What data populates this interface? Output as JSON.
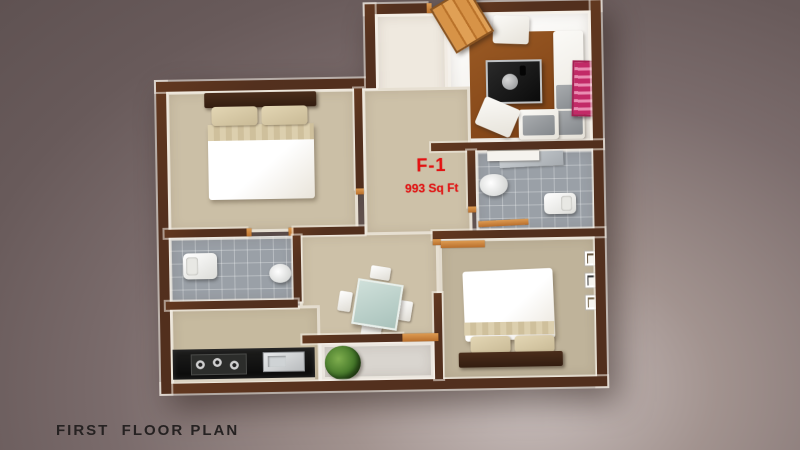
{
  "page": {
    "caption": "FIRST  FLOOR PLAN"
  },
  "unit": {
    "label": "F-1",
    "area": "993 Sq Ft"
  },
  "colors": {
    "background_dark": "#5f5252",
    "background_mid": "#7b6c6c",
    "background_glow": "#cdc3c1",
    "wall_brown": "#53301e",
    "wood_door": "#cd8a43",
    "floor_beige": "#cdc1a8",
    "tile_gray": "#9aa0a7",
    "inner_face_white": "#f3efe8",
    "unit_label_red": "#e31212",
    "rug_brown": "#8a4a1b",
    "counter_black": "#141414",
    "art_pink": "#c22a67",
    "plant_green": "#3f7226",
    "caption_dark": "#262222"
  },
  "rooms": [
    "living-room",
    "foyer",
    "bedroom-1",
    "bathroom-1",
    "kitchen",
    "dining-hall",
    "bathroom-2",
    "bedroom-2",
    "balcony"
  ],
  "furniture": [
    "entry-door",
    "l-shaped-sofa",
    "ottoman",
    "coffee-table",
    "rug",
    "wall-art",
    "double-bed",
    "pillow",
    "wash-basin",
    "toilet",
    "kitchen-counter",
    "gas-hob",
    "kitchen-sink",
    "dining-table",
    "dining-chair",
    "potted-plant",
    "picture-frame",
    "vanity-counter"
  ]
}
